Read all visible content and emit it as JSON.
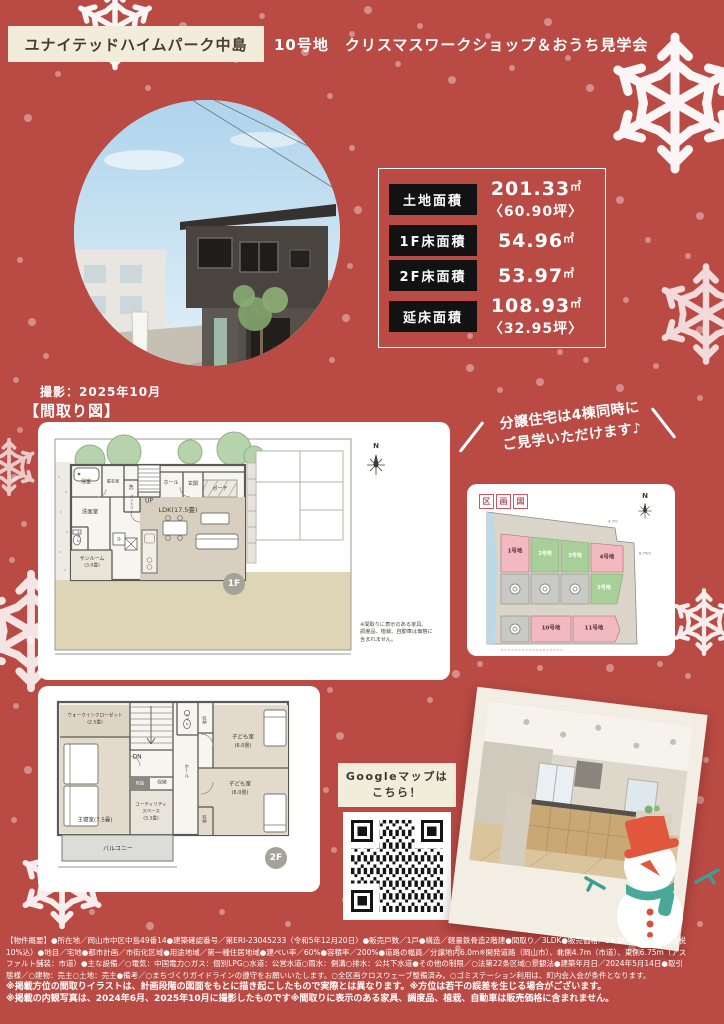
{
  "colors": {
    "background": "#b94a44",
    "cream": "#f2ecdb",
    "lot_pink": "#f3b9c1",
    "lot_green": "#a7cf97",
    "lot_sold_gray": "#c9c9c5",
    "badge_gray": "#a3a39a",
    "snowman_hat": "#e0573e",
    "scarf_teal": "#4aa89a"
  },
  "header": {
    "project_name": "ユナイテッドハイムパーク中島",
    "event_title": "10号地　クリスマスワークショップ＆おうち見学会"
  },
  "photo": {
    "caption": "撮影：2025年10月"
  },
  "section": {
    "floorplan_heading": "【間取り図】"
  },
  "area_table": {
    "rows": [
      {
        "label": "土地面積",
        "value": "201.33",
        "unit": "㎡",
        "sub": "〈60.90坪〉"
      },
      {
        "label": "1F床面積",
        "value": "54.96",
        "unit": "㎡",
        "sub": ""
      },
      {
        "label": "2F床面積",
        "value": "53.97",
        "unit": "㎡",
        "sub": ""
      },
      {
        "label": "延床面積",
        "value": "108.93",
        "unit": "㎡",
        "sub": "〈32.95坪〉"
      }
    ]
  },
  "banner": {
    "line1": "分譲住宅は4棟同時に",
    "line2": "ご見学いただけます♪"
  },
  "plot_map": {
    "title_chars": [
      "区",
      "画",
      "図"
    ],
    "compass": "N",
    "dim_top": "4.7m",
    "dim_right": "6.75m",
    "lots": {
      "l1": "1号地",
      "l2": "2号地",
      "l3": "3号地",
      "l4": "4号地",
      "l5": "5号地",
      "l10": "10号地",
      "l11": "11号地"
    }
  },
  "floor1": {
    "badge": "1F",
    "compass": "N",
    "rooms": {
      "bath": "浴室",
      "dressing": "脱衣室",
      "laundry": "洗",
      "pantry": "パントリー",
      "up": "UP",
      "hall": "ホール",
      "entrance": "玄関",
      "porch": "ポーチ",
      "ldk": "LDK(17.5畳)",
      "powder": "洗面室",
      "toilet": "トイレ",
      "sunroom1": "サンルーム",
      "sunroom2": "(3.0畳)",
      "fridge": "冷"
    },
    "note_lines": [
      "※間取りに表示のある家具、",
      "調度品、植栽、自動車は価格に",
      "含まれません。"
    ]
  },
  "floor2": {
    "badge": "2F",
    "rooms": {
      "wic1": "ウォークインクローゼット",
      "wic2": "(2.5畳)",
      "dn": "DN",
      "toilet": "トイレ",
      "closet_top": "収納",
      "kids1a": "子ども室",
      "kids1b": "(6.0畳)",
      "kids2a": "子ども室",
      "kids2b": "(6.0畳)",
      "hall": "ホール",
      "void": "吹抜",
      "closet_mid": "収納",
      "utility1": "ユーティリティ",
      "utility2": "スペース",
      "utility3": "(3.3畳)",
      "master": "主寝室(7.5畳)",
      "closet_right": "収納",
      "balcony": "バルコニー"
    }
  },
  "map_link": {
    "line1": "Googleマップは",
    "line2": "こちら！"
  },
  "footer": {
    "lines": [
      "【物件概要】●所在地／岡山市中区中島49番14●建築確認番号／第ERI-23045233〈令和5年12月20日〉●販売戸数／1戸●構造／軽量鉄骨造2階建●間取り／3LDK●販売価格／59,000,000円（消費税",
      "10%込）●地目／宅地●都市計画／市街化区域●用途地域／第一種住居地域●建ぺい率／60%●容積率／200%●道路の幅員／分譲地内6.0m※開発道路（岡山市）、北側4.7m（市道）、東側6.75m（アス",
      "ファルト舗装：市道）●主な設備／○電気：中国電力○ガス：個別LPG○水道：公営水道○雨水：側溝○排水：公共下水道●その他の制限／○法第22条区域○景観法●建築年月日／2024年5月14日●取引",
      "態様／○建物：売主○土地：売主●備考／○まちづくりガイドラインの遵守をお願いいたします。○全区画クロスウェーブ整備済み。○ゴミステーション利用は、町内会入会が条件となります。",
      "※掲載方位の間取りイラストは、計画段階の図面をもとに描き起こしたもので実際とは異なります。※方位は若干の誤差を生じる場合がございます。",
      "※掲載の内観写真は、2024年6月、2025年10月に撮影したものです※間取りに表示のある家具、調度品、植栽、自動車は販売価格に含まれません。"
    ]
  }
}
